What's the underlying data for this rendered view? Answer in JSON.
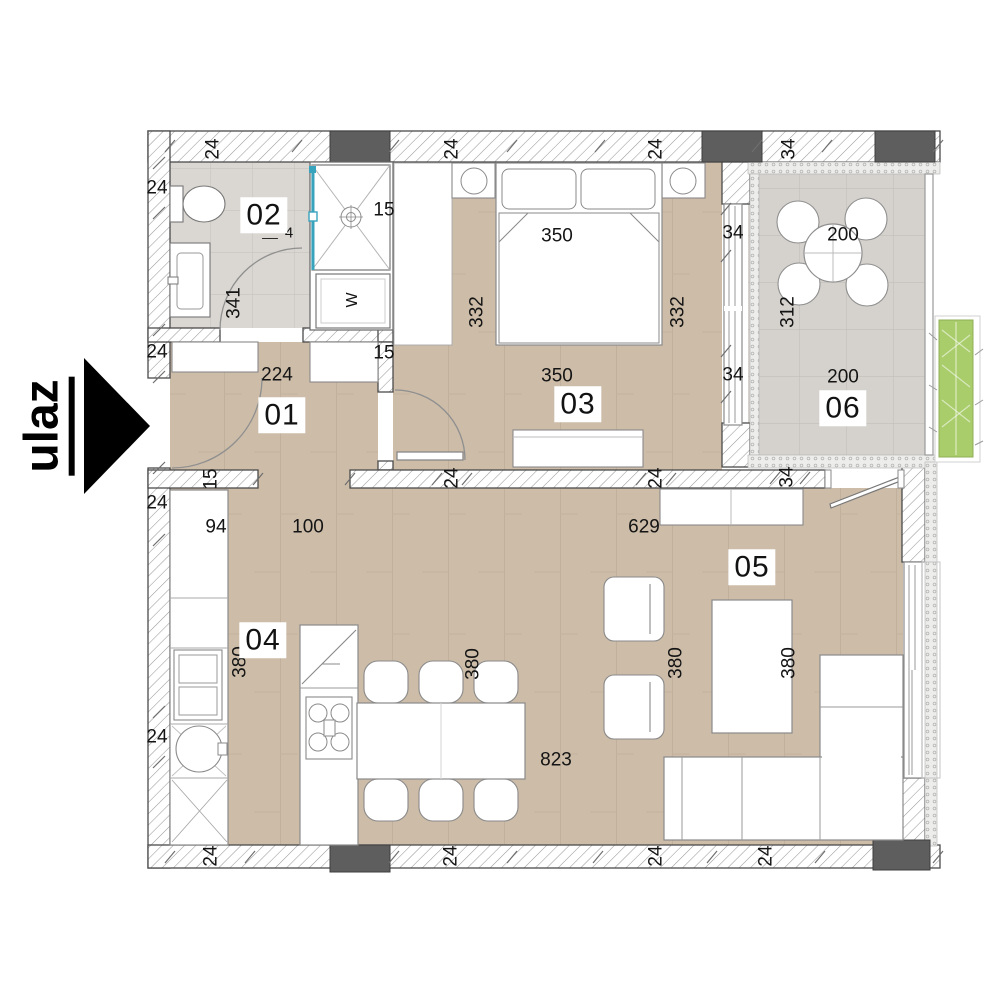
{
  "title": "apartment-floor-plan",
  "entrance": {
    "label": "ulaz"
  },
  "colors": {
    "wood_floor": "#ccbca8",
    "wood_grain": "#bcab97",
    "bath_tile": "#dad7d2",
    "bath_tile_line": "#c7c4bf",
    "terrace_tile": "#d5d2cd",
    "terrace_tile_line": "#c2bfba",
    "wall_hatch_line": "#9a9a9a",
    "wall_border": "#4a4a4a",
    "pillar": "#5e5e5e",
    "furniture_stroke": "#8a8a8a",
    "shower_glass": "#38a3bd",
    "planter_green": "#a9cd6b",
    "arrow_black": "#000000"
  },
  "plan": {
    "room_labels": [
      {
        "n": "01",
        "x": 282,
        "y": 415
      },
      {
        "n": "02",
        "x": 264,
        "y": 215
      },
      {
        "n": "03",
        "x": 578,
        "y": 404
      },
      {
        "n": "04",
        "x": 263,
        "y": 640
      },
      {
        "n": "05",
        "x": 752,
        "y": 567
      },
      {
        "n": "06",
        "x": 843,
        "y": 408
      }
    ],
    "annotations": [
      {
        "t": "24",
        "x": 213,
        "y": 149,
        "r": -90
      },
      {
        "t": "24",
        "x": 452,
        "y": 149,
        "r": -90
      },
      {
        "t": "24",
        "x": 656,
        "y": 149,
        "r": -90
      },
      {
        "t": "34",
        "x": 789,
        "y": 149,
        "r": -90
      },
      {
        "t": "24",
        "x": 157,
        "y": 188
      },
      {
        "t": "24",
        "x": 157,
        "y": 352
      },
      {
        "t": "24",
        "x": 157,
        "y": 503
      },
      {
        "t": "24",
        "x": 157,
        "y": 737
      },
      {
        "t": "24",
        "x": 211,
        "y": 856,
        "r": -90
      },
      {
        "t": "24",
        "x": 451,
        "y": 856,
        "r": -90
      },
      {
        "t": "24",
        "x": 656,
        "y": 856,
        "r": -90
      },
      {
        "t": "24",
        "x": 766,
        "y": 856,
        "r": -90
      },
      {
        "t": "341",
        "x": 234,
        "y": 303,
        "r": -90
      },
      {
        "t": "15",
        "x": 384,
        "y": 210
      },
      {
        "t": "__",
        "x": 270,
        "y": 231,
        "s": 14
      },
      {
        "t": "4",
        "x": 289,
        "y": 233,
        "s": 15
      },
      {
        "t": "224",
        "x": 277,
        "y": 375
      },
      {
        "t": "15",
        "x": 384,
        "y": 353
      },
      {
        "t": "15",
        "x": 211,
        "y": 479,
        "r": -90
      },
      {
        "t": "350",
        "x": 557,
        "y": 236
      },
      {
        "t": "332",
        "x": 477,
        "y": 312,
        "r": -90
      },
      {
        "t": "332",
        "x": 678,
        "y": 312,
        "r": -90
      },
      {
        "t": "350",
        "x": 557,
        "y": 376
      },
      {
        "t": "24",
        "x": 452,
        "y": 478,
        "r": -90
      },
      {
        "t": "24",
        "x": 656,
        "y": 478,
        "r": -90
      },
      {
        "t": "34",
        "x": 733,
        "y": 233
      },
      {
        "t": "34",
        "x": 733,
        "y": 375
      },
      {
        "t": "200",
        "x": 843,
        "y": 235
      },
      {
        "t": "312",
        "x": 788,
        "y": 312,
        "r": -90
      },
      {
        "t": "200",
        "x": 843,
        "y": 377
      },
      {
        "t": "34",
        "x": 787,
        "y": 477,
        "r": -90
      },
      {
        "t": "94",
        "x": 216,
        "y": 527
      },
      {
        "t": "100",
        "x": 308,
        "y": 527
      },
      {
        "t": "629",
        "x": 644,
        "y": 527
      },
      {
        "t": "380",
        "x": 240,
        "y": 662,
        "r": -90
      },
      {
        "t": "380",
        "x": 473,
        "y": 664,
        "r": -90
      },
      {
        "t": "380",
        "x": 676,
        "y": 663,
        "r": -90
      },
      {
        "t": "380",
        "x": 789,
        "y": 663,
        "r": -90
      },
      {
        "t": "823",
        "x": 556,
        "y": 760
      },
      {
        "t": "W",
        "x": 353,
        "y": 300,
        "r": -90,
        "s": 16
      }
    ]
  }
}
